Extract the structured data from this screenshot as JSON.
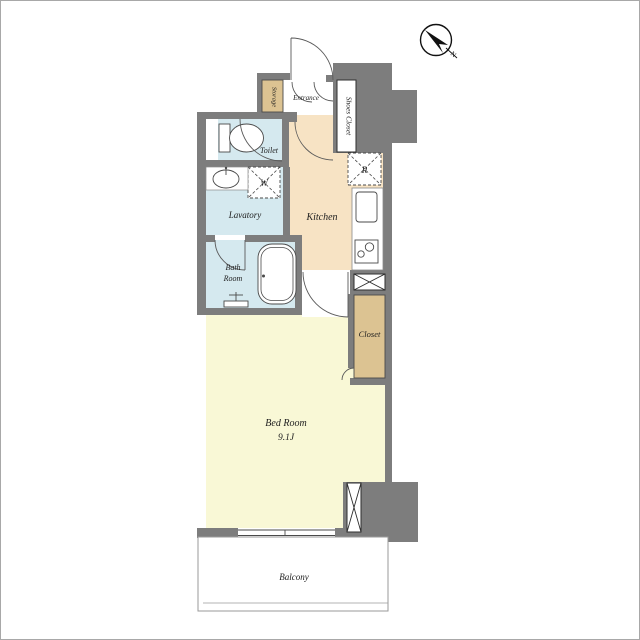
{
  "compass": {
    "north_label": "N"
  },
  "rooms": {
    "entrance": "Entrance",
    "storage": "Storage",
    "shoes_closet": "Shoes Closet",
    "toilet": "Toilet",
    "lavatory": "Lavatory",
    "kitchen": "Kitchen",
    "bath_room": [
      "Bath",
      "Room"
    ],
    "closet": "Closet",
    "bed_room": {
      "name": "Bed Room",
      "size": "9.1J"
    },
    "balcony": "Balcony"
  },
  "markers": {
    "washing_machine": "W",
    "refrigerator": "R"
  },
  "colors": {
    "wall": "#7d7d7d",
    "wet_area": "#d5e9ef",
    "kitchen_floor": "#f7e3c4",
    "closet_fill": "#dcc392",
    "bedroom_floor": "#f9f8d6"
  }
}
